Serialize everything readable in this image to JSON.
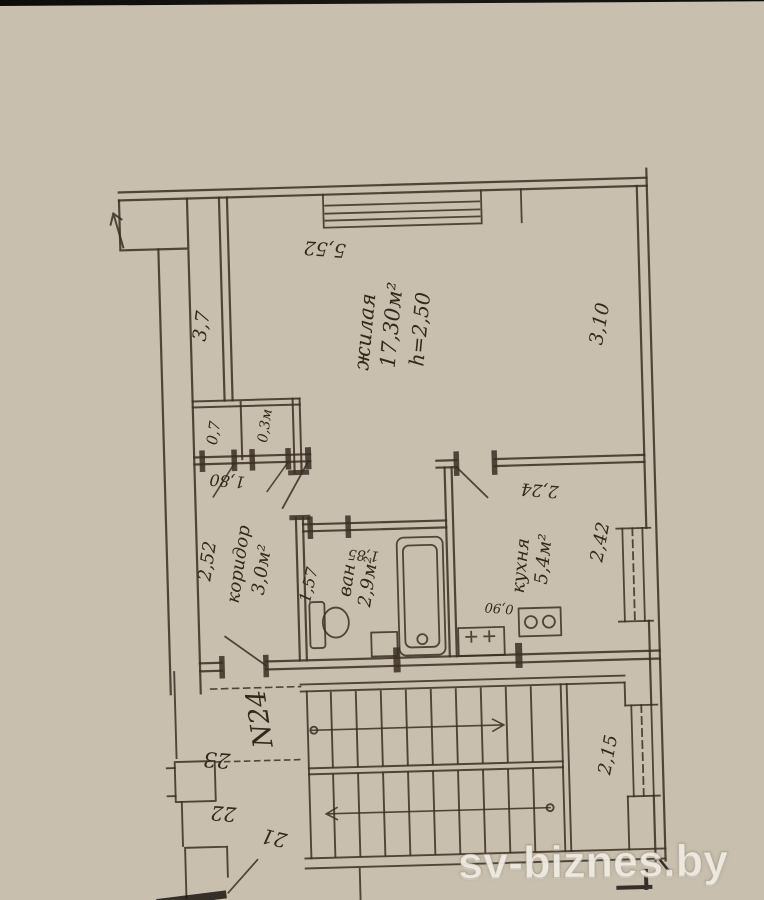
{
  "watermark": "sv-biznes.by",
  "plan": {
    "apartment_label": "N24",
    "rooms": {
      "living": {
        "name": "жилая",
        "area": "17,30м²",
        "height": "h=2,50"
      },
      "kitchen": {
        "name": "кухня",
        "area": "5,4м²"
      },
      "corridor": {
        "name": "коридор",
        "area": "3,0м²"
      },
      "bath": {
        "name": "ван",
        "area": "2,9м²"
      },
      "closet_left": {
        "area": "0,7"
      },
      "closet_right": {
        "area": "0,3м"
      }
    },
    "dimensions": {
      "top": "5,52",
      "living_left": "3,7",
      "living_right": "3,10",
      "kitchen_top": "2,24",
      "kitchen_window": "2,42",
      "kitchen_front": "0,90",
      "corridor": "2,52",
      "closet_doors": "1,80",
      "bath_left": "1,57",
      "bath_top": "1,85",
      "stair_window": "2,15"
    },
    "adjacent_units": {
      "u21": "21",
      "u22": "22",
      "u23": "23"
    }
  }
}
